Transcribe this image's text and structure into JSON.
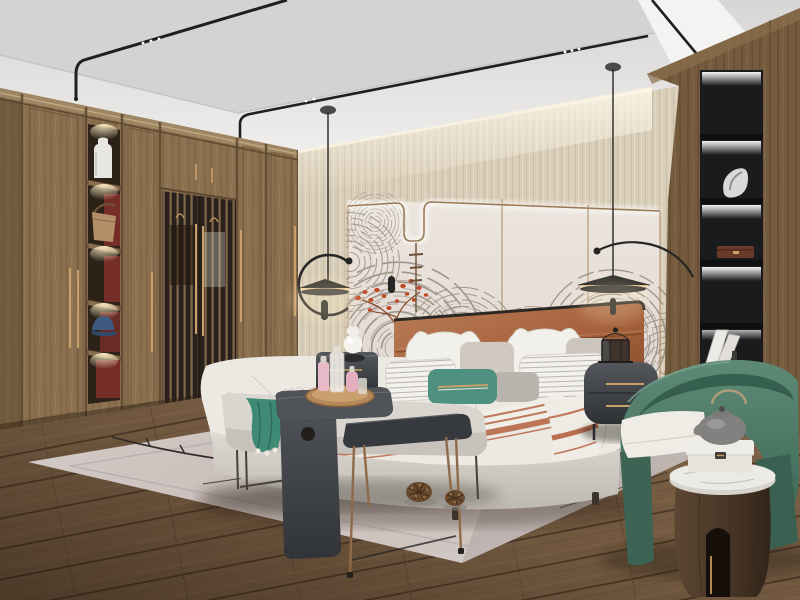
{
  "scene": {
    "type": "interior-3d-render",
    "room": "modern chinese style bedroom",
    "objects": [
      "ceiling with recessed panel and black magnetic track lights",
      "wood wardrobe with framed doors, lattice sliding doors and lit display niches",
      "display niches holding white vase, tan handbag and blue cap",
      "beige grasscloth feature wall with LED cove",
      "cream wall panels with bronze trim outline and gray wave-fan mural",
      "red coral branch artwork",
      "two black disc pendant lamps with arc arms",
      "upholstered bed with caramel leather headboard",
      "white pillows, striped pillows, teal banded pillow, bolster",
      "white duvet with terracotta striped throw",
      "dark charcoal nightstands with brass handles",
      "white gourd table lamp",
      "miniature black lantern decor",
      "long upholstered bench with teal throw and bead garland",
      "charcoal waterfall side table with round wooden tray and perfume bottles",
      "metal-leg occasional table",
      "black built-in display shelf with sculpture, box and books",
      "green barrel armchair with white cushion",
      "cylinder walnut side table with marble top, marble box and gray teapot",
      "large light gray area rug with branch line pattern",
      "two pinecones on rug",
      "wide plank wood floor"
    ]
  },
  "colors": {
    "ceiling": "#e2e1df",
    "ceilingRecess": "#d3d2d0",
    "soffitWhite": "#f4f3f1",
    "railBlack": "#1f1f1f",
    "wallBeige": "#d8cdb8",
    "panelCream": "#e9e2da",
    "bronzeLine": "#9b7a58",
    "muralLine": "#8e857a",
    "coralRed": "#c14a26",
    "wardrobeWood": "#8b7050",
    "wardrobeDark": "#6b5438",
    "nicheRed": "#7d2f2a",
    "latticeDark": "#2e2620",
    "rightWood": "#755b3e",
    "shelfBlack": "#26282a",
    "floorWood": "#82664a",
    "floorDark": "#4e3a29",
    "rugBase": "#d2ccc8",
    "rugTint": "#c5b2ae",
    "bedWhite": "#ece9e3",
    "bedBase": "#d8d5cf",
    "headboard": "#a5613c",
    "headboardDark": "#7e4526",
    "tealPillow": "#4f9180",
    "tealThrow": "#3f8a74",
    "throwStripe": "#c0795a",
    "charcoal": "#3f4246",
    "brass": "#c9a06a",
    "copper": "#8f6a4a",
    "chairGreen": "#527f6c",
    "chairGreenDark": "#33594a",
    "cushionWhite": "#efece6",
    "tableWalnut": "#4e3b2b",
    "marble": "#e9e6e1",
    "teapotGray": "#8e8d8b",
    "pinecone": "#6a4a2e",
    "lampBlack": "#262626"
  }
}
